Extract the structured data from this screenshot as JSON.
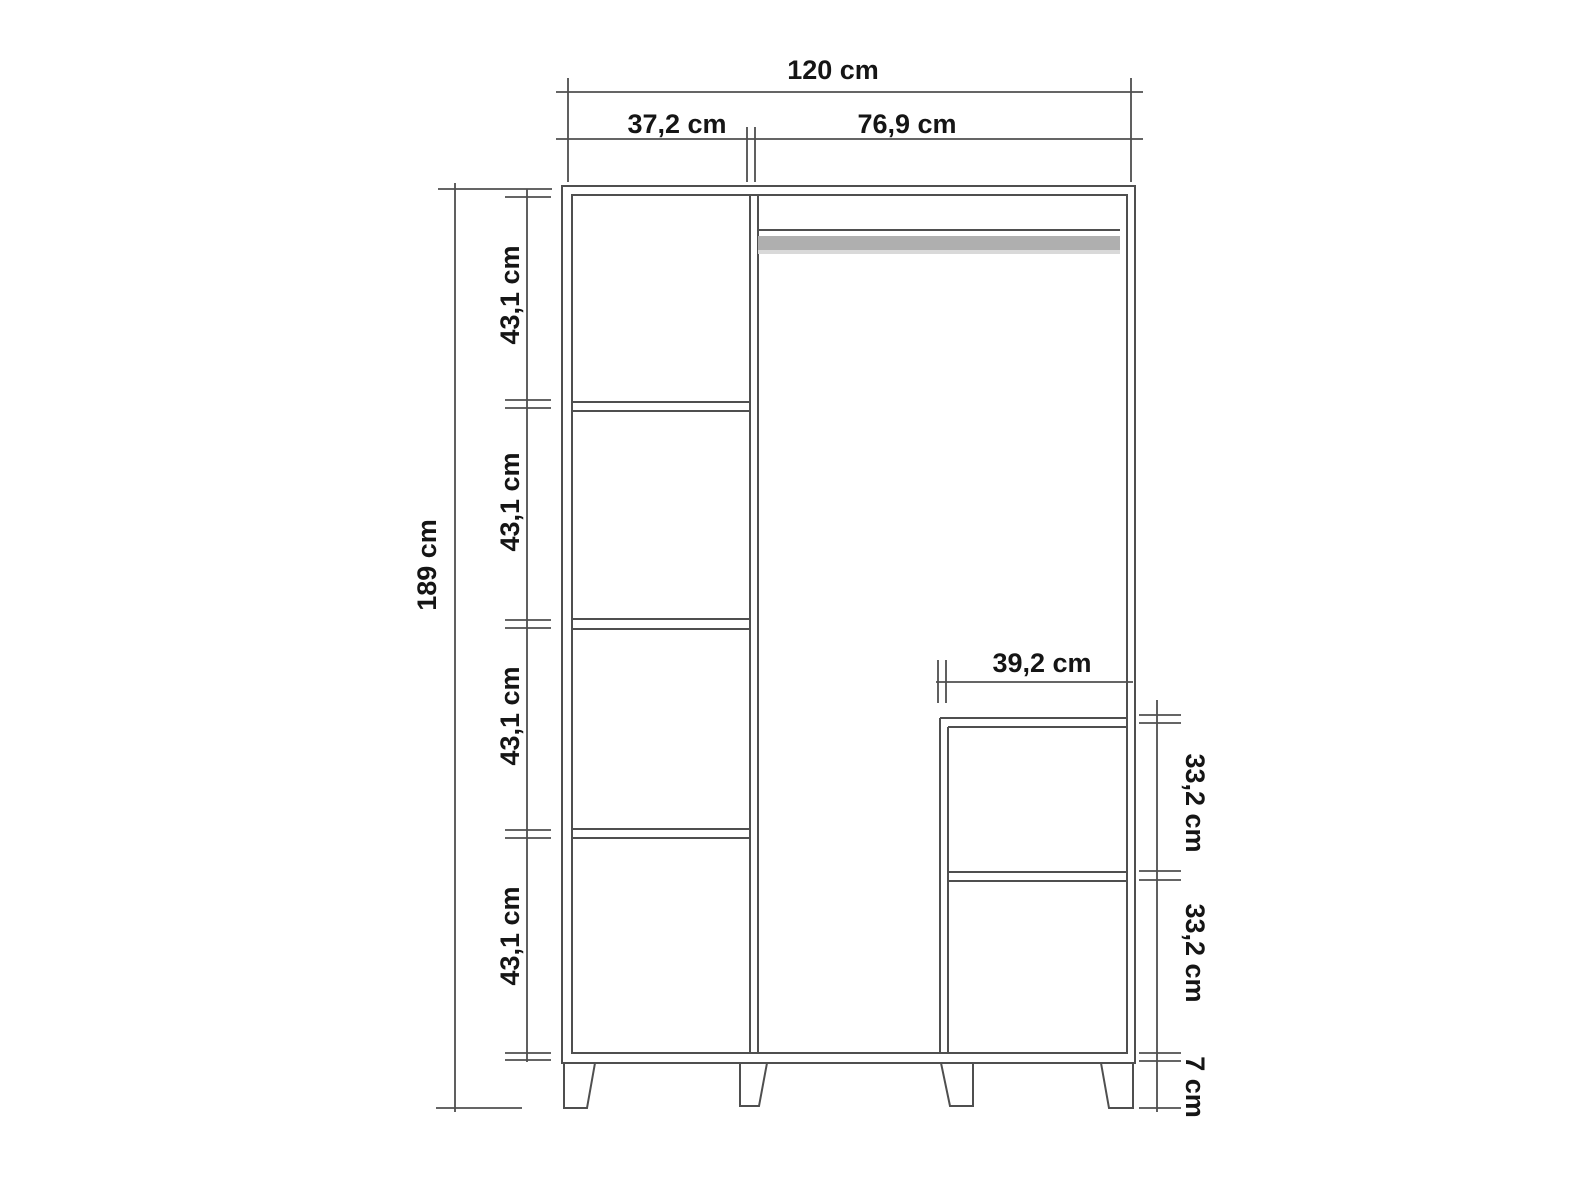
{
  "diagram": {
    "labels": {
      "total_width": "120 cm",
      "left_section_width": "37,2 cm",
      "right_section_width": "76,9 cm",
      "total_height": "189 cm",
      "left_shelf_heights": [
        "43,1 cm",
        "43,1 cm",
        "43,1 cm",
        "43,1 cm"
      ],
      "inner_section_width": "39,2 cm",
      "right_shelf_heights": [
        "33,2 cm",
        "33,2 cm"
      ],
      "leg_height": "7 cm"
    },
    "colors": {
      "line": "#4f4f4f",
      "text": "#151515",
      "rail": "#afafaf",
      "rail_light": "#d9d9d9",
      "background": "#ffffff"
    }
  }
}
